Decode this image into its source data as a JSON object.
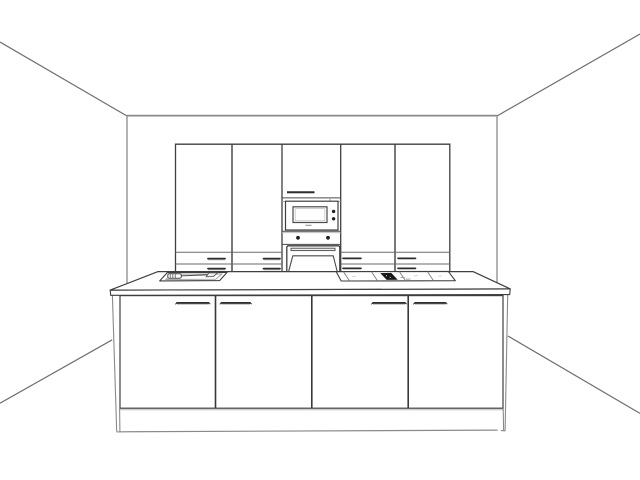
{
  "view": {
    "label": "kitchen-3d-preview"
  },
  "palette": {
    "background": "#ffffff",
    "outline": "#3f3f3f",
    "detail": "#4a4a4a",
    "light_line": "#9a9a9a",
    "faint_line": "#c4c4c4",
    "room_line": "#6e6e6e",
    "wall_edge": "#8a8a8a",
    "handle": "#2e2e2e",
    "knob": "#1f1f1f",
    "hob_control": "#181818",
    "fill": "#ffffff"
  },
  "scene": {
    "room": {
      "element": "perspective-room-box",
      "walls_visible": 3
    },
    "tall_cabinet_run": {
      "units": 5,
      "door_columns": 4,
      "drawer_rows": 2,
      "drawer_handles": 8
    },
    "appliance_column": {
      "items": [
        "upper-door",
        "microwave",
        "oven-control-panel",
        "oven"
      ],
      "microwave_knobs": 2,
      "oven_knobs": 2
    },
    "island": {
      "doors": 4,
      "door_handles": 4,
      "top_items": [
        "sink",
        "faucet",
        "cooktop"
      ],
      "cooktop_zones": 4,
      "has_plinth": true
    }
  }
}
